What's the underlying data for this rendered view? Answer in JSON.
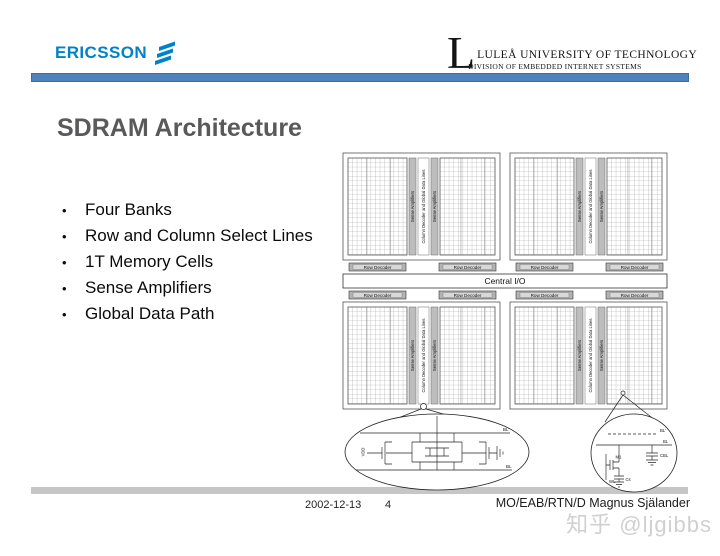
{
  "colors": {
    "header_bar": "#4f81bd",
    "ericsson_blue": "#0082c9",
    "footer_bar": "#c6c6c6",
    "watermark_gray": "#d0d0d0",
    "title_gray": "#58595b"
  },
  "header": {
    "ericsson_text": "ERICSSON",
    "university": {
      "dropcap": "L",
      "line1": "LULEÅ UNIVERSITY OF TECHNOLOGY",
      "line2": "DIVISION OF EMBEDDED INTERNET SYSTEMS"
    }
  },
  "slide": {
    "title": "SDRAM Architecture",
    "bullet_char": "•",
    "bullets": [
      "Four Banks",
      "Row and Column Select Lines",
      "1T Memory Cells",
      "Sense Amplifiers",
      "Global Data Path"
    ]
  },
  "diagram": {
    "row_decoder_label": "Row Decoder",
    "sense_amp_label": "Sense Amplifiers",
    "column_decoder_label": "Column Decoder and Global Data Lines",
    "central_io_label": "Central I/O",
    "sense_amp_callout": {
      "vdd": "VDD",
      "bl_top": "BL'",
      "bl_bottom": "BL"
    },
    "cell_callout": {
      "bl_top": "BL'",
      "bl_bottom": "BL",
      "transistor": "M1",
      "storage_cap": "Cs",
      "bitline_cap": "CBL",
      "wordline": "WL"
    }
  },
  "footer": {
    "date": "2002-12-13",
    "page": "4",
    "author": "MO/EAB/RTN/D Magnus Själander"
  },
  "watermark": {
    "text": "知乎 @ljgibbs"
  }
}
